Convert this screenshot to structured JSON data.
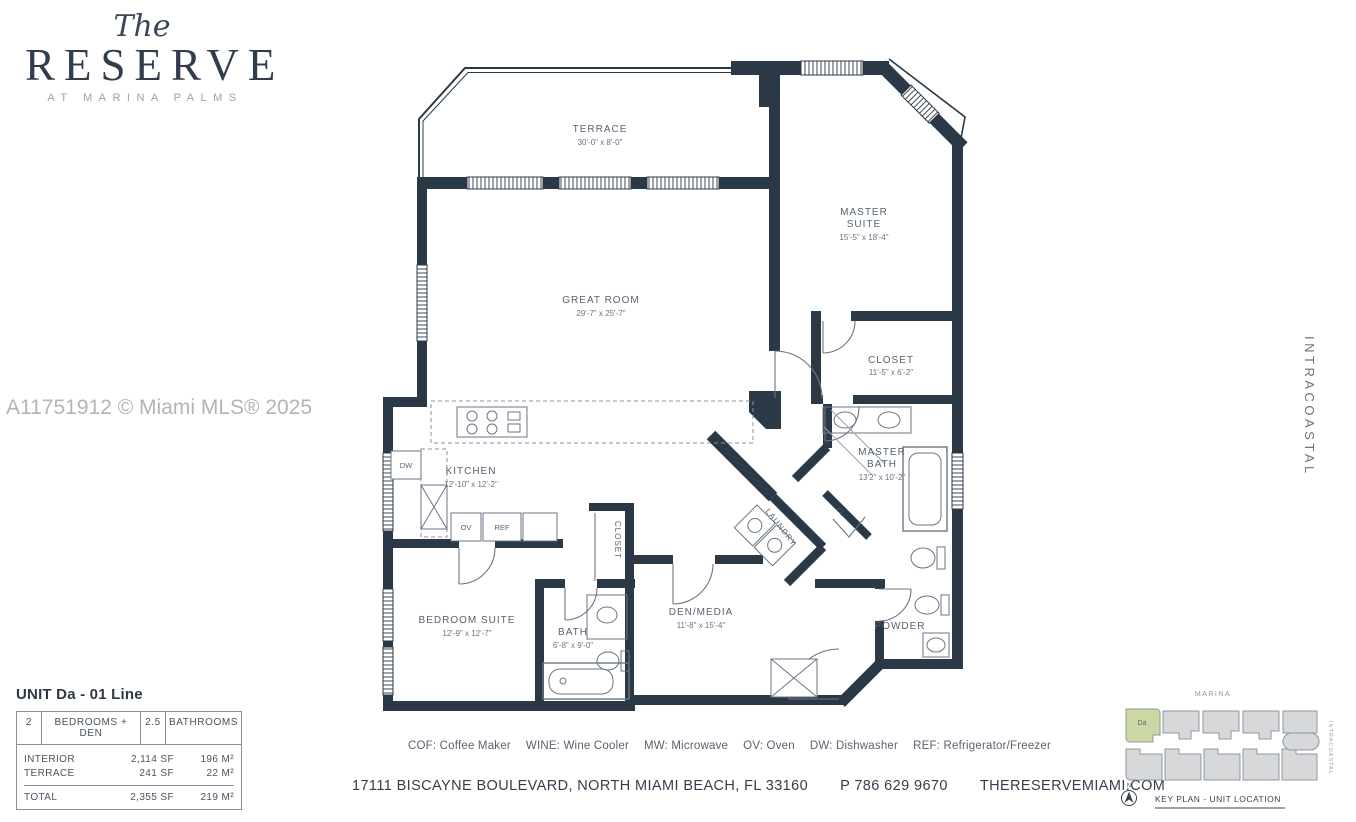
{
  "logo": {
    "script": "The",
    "name": "RESERVE",
    "tagline": "AT MARINA PALMS"
  },
  "watermark": "A11751912 © Miami MLS® 2025",
  "intracoastal_label": "INTRACOASTAL",
  "floorplan": {
    "rooms": {
      "terrace": {
        "name": "TERRACE",
        "dims": "30'-0\" x 8'-0\""
      },
      "master_suite": {
        "line1": "MASTER",
        "line2": "SUITE",
        "dims": "15'-5\" x 18'-4\""
      },
      "great_room": {
        "name": "GREAT ROOM",
        "dims": "29'-7\" x 25'-7\""
      },
      "closet": {
        "name": "CLOSET",
        "dims": "11'-5\" x 6'-2\""
      },
      "kitchen": {
        "name": "KITCHEN",
        "dims": "12'-10\" x 12'-2\""
      },
      "master_bath": {
        "line1": "MASTER",
        "line2": "BATH",
        "dims": "13'2\" x 10'-2\""
      },
      "bedroom_suite": {
        "name": "BEDROOM SUITE",
        "dims": "12'-9\" x 12'-7\""
      },
      "bath": {
        "name": "BATH",
        "dims": "6'-8\" x 9'-0\""
      },
      "den_media": {
        "name": "DEN/MEDIA",
        "dims": "11'-8\" x 15'-4\""
      },
      "powder": {
        "name": "POWDER"
      },
      "laundry": {
        "name": "LAUNDRY"
      },
      "closet_hall": {
        "name": "CLOSET"
      },
      "cl": {
        "name": "CL"
      }
    },
    "appliances": {
      "dw": "DW",
      "ov": "OV",
      "ref": "REF"
    }
  },
  "unit_info": {
    "title": "UNIT Da - 01 Line",
    "header": {
      "bed_count": "2",
      "bed_label": "BEDROOMS + DEN",
      "bath_count": "2.5",
      "bath_label": "BATHROOMS"
    },
    "rows": [
      {
        "label": "INTERIOR",
        "sf": "2,114 SF",
        "m2": "196 M²"
      },
      {
        "label": "TERRACE",
        "sf": "241 SF",
        "m2": "22 M²"
      }
    ],
    "total": {
      "label": "TOTAL",
      "sf": "2,355 SF",
      "m2": "219 M²"
    }
  },
  "legend": [
    "COF: Coffee Maker",
    "WINE: Wine Cooler",
    "MW: Microwave",
    "OV: Oven",
    "DW: Dishwasher",
    "REF: Refrigerator/Freezer"
  ],
  "footer": {
    "address": "17111 BISCAYNE BOULEVARD, NORTH MIAMI BEACH, FL 33160",
    "phone": "P 786 629 9670",
    "website": "THERESERVEMIAMI.COM"
  },
  "keyplan": {
    "marina": "MARINA",
    "intracoastal": "INTRACOASTAL",
    "unit": "Da",
    "north": "N",
    "caption": "KEY PLAN - UNIT LOCATION",
    "highlight_color": "#ccd8a3"
  }
}
